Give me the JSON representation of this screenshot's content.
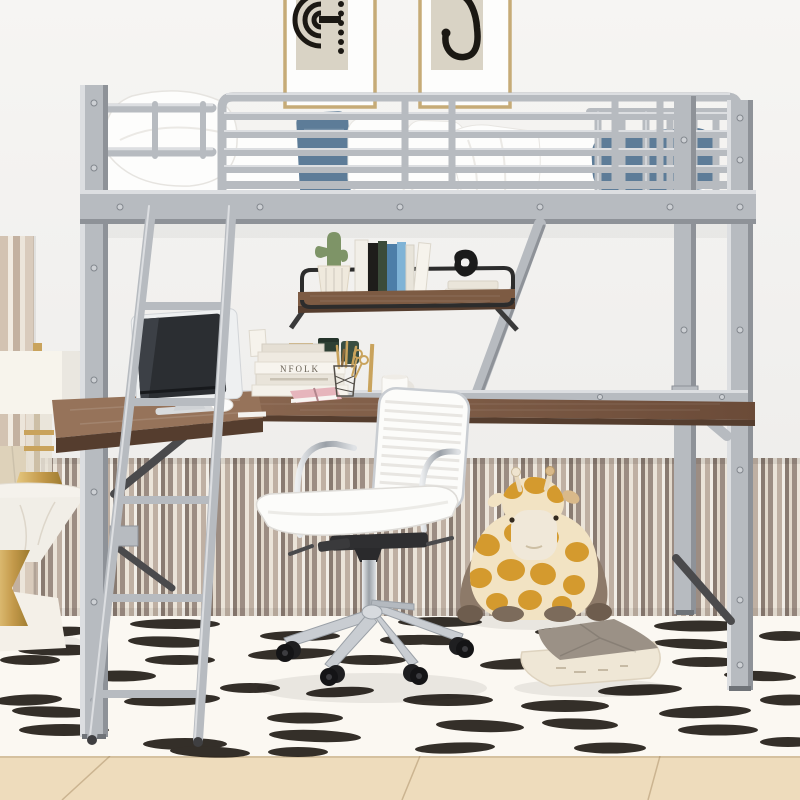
{
  "meta": {
    "title": "Kids room product photo: silver metal loft bed with desk, shelf, white office chair, giraffe plush and dash-pattern rug"
  },
  "palette": {
    "wall": "#f4f3f1",
    "rug": "#fbf8f2",
    "rug_dash": "#241e18",
    "floor_wood": "#eedcbc",
    "metal": "#b7bbc0",
    "metal_dark": "#8e9298",
    "metal_light": "#dcdee1",
    "ink": "#1b1813",
    "wood": "#7d5b43",
    "wood_dark": "#553d2e",
    "denim": "#5d7c98",
    "gold": "#c9a35c",
    "frame_gold": "#c6ab77",
    "soft_white": "#fdfdfc",
    "chair_white": "#fcfcfa",
    "chrome": "#c3c7cc",
    "screen": "#2b2e32",
    "giraffe_gold": "#d49a2e",
    "giraffe_cream": "#f2e3c3",
    "giraffe_limb": "#8d7a69",
    "pillow_gray": "#9b9186",
    "pillow_cream": "#efe7d6",
    "cactus": "#7e9467",
    "jar_green": "#2e4034",
    "book_pink": "#e6b5bc"
  },
  "wall_art": {
    "left_frame_motif": "concentric black arcs with dot column",
    "right_frame_motif": "abstract ear-shaped black curve with dots"
  },
  "bed": {
    "material": "silver metal tube frame",
    "bedding": "white sheets and pillows",
    "accent_pillows": "denim blue cushion and bolster",
    "parts": [
      "left-post",
      "headboard-rails",
      "guard-rail",
      "foot-slats",
      "side-beam",
      "rear-right-post",
      "front-right-post",
      "diagonal-braces"
    ]
  },
  "ladder": {
    "rungs": 5
  },
  "shelf": {
    "items": [
      "cactus-in-ribbed-pot",
      "book-row",
      "tall-white-book",
      "stacked-white-books",
      "black-knot-sculpture"
    ],
    "frame": "black metal rail on wood board"
  },
  "desk": {
    "book_spine_text": "NFOLK",
    "items": [
      "imac-monitor",
      "stacked-books",
      "brass-frame",
      "green-canisters",
      "pink-book",
      "wire-pencil-cup",
      "gold-scissors",
      "brass-ruler",
      "white-mug",
      "white-mouse"
    ]
  },
  "chair": {
    "style": "white ribbed swivel office chair",
    "base": "chrome 5-star base with black casters"
  },
  "plush_giraffe": {
    "pose": "sitting against striped wainscot wall"
  },
  "floor_pillow": {
    "style": "two-tone taupe and cream throw pillow"
  },
  "side_lamp_corner": {
    "items": [
      "drum-shade-lamp",
      "glass-column",
      "gold-lamp-base",
      "faceted-vase",
      "marble-side-table",
      "gold-hourglass-pedestal"
    ]
  },
  "rug": {
    "pattern": "black brush-stroke dashes on ivory"
  },
  "floor": {
    "material": "light oak planks"
  }
}
